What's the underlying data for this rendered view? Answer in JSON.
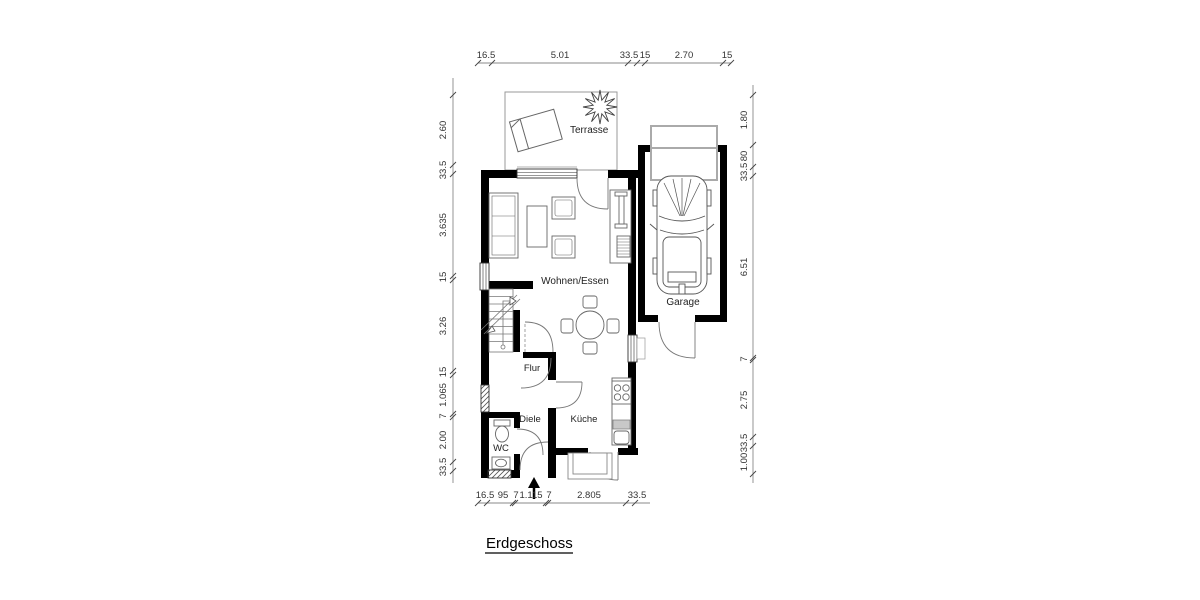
{
  "page": {
    "title_label": "Erdgeschoss"
  },
  "rooms": {
    "terrasse": "Terrasse",
    "wohnen_essen": "Wohnen/Essen",
    "garage": "Garage",
    "flur": "Flur",
    "diele": "Diele",
    "kueche": "Küche",
    "wc": "WC"
  },
  "dimensions": {
    "top": [
      "16.5",
      "5.01",
      "33.5",
      "15",
      "2.70",
      "15"
    ],
    "left": [
      "2.60",
      "33.5",
      "3.635",
      "15",
      "3.26",
      "15",
      "1.065",
      "7",
      "2.00",
      "33.5"
    ],
    "right": [
      "1.80",
      "80",
      "33.5",
      "6.51",
      "7",
      "2.75",
      "33.5",
      "1.00"
    ],
    "bottom": [
      "16.5",
      "95",
      "7",
      "1.115",
      "7",
      "2.805",
      "33.5"
    ]
  },
  "colors": {
    "wall": "#000000",
    "dim_line": "#888888",
    "dim_text": "#333333",
    "room_text": "#222222",
    "garage_door": "#aaaaaa"
  }
}
